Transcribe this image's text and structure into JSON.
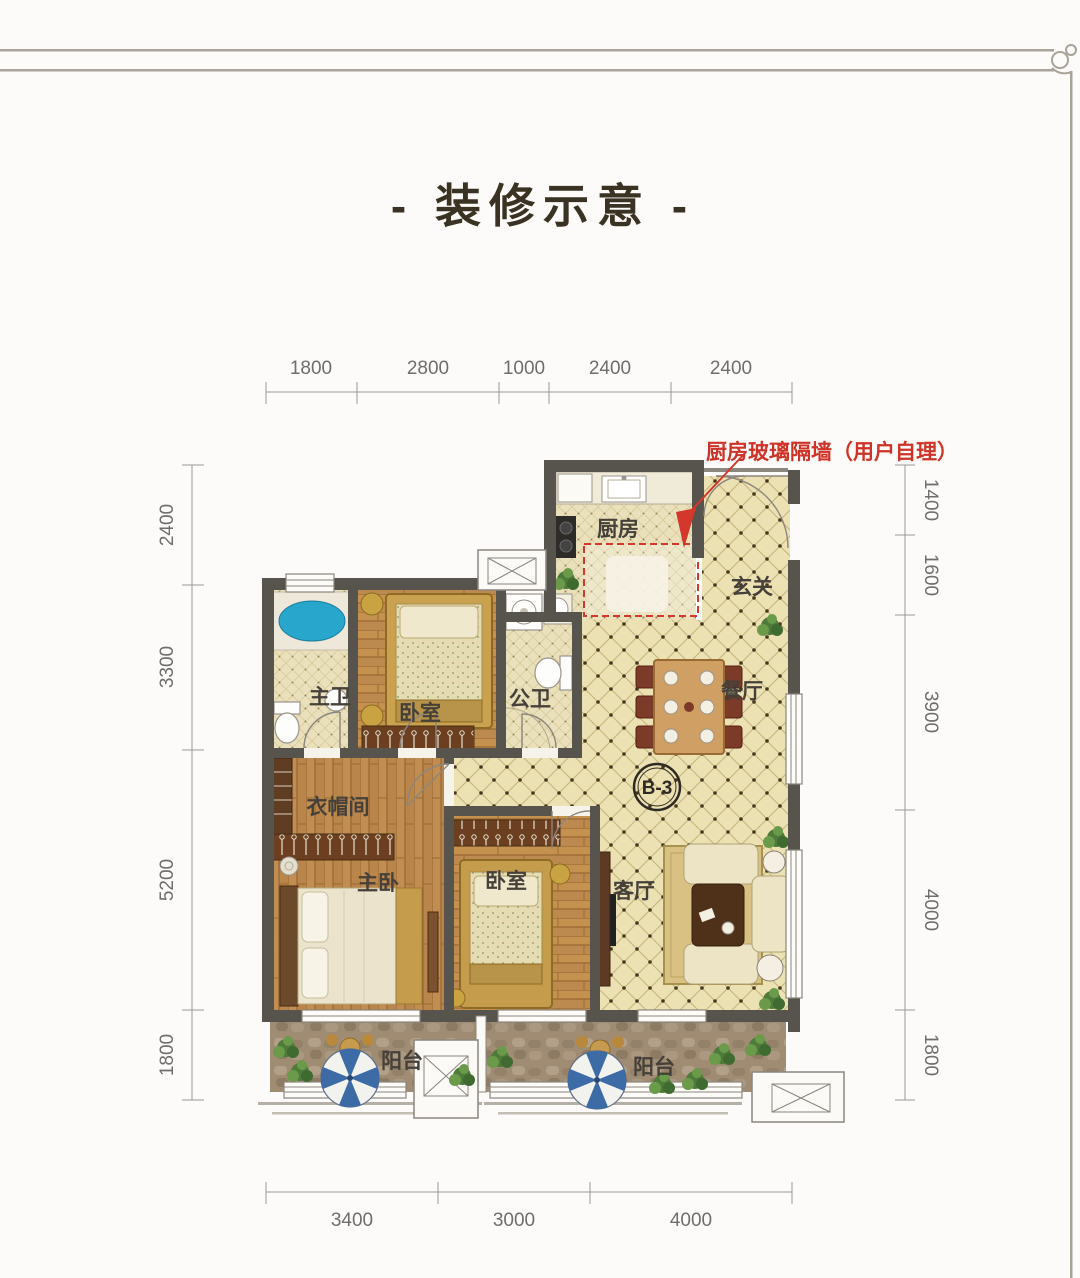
{
  "title": "- 装修示意 -",
  "annotation": {
    "text": "厨房玻璃隔墙（用户自理）",
    "color": "#cf3227"
  },
  "unit_label": "B-3",
  "dimensions": {
    "top": [
      "1800",
      "2800",
      "1000",
      "2400",
      "2400"
    ],
    "bottom": [
      "3400",
      "3000",
      "4000"
    ],
    "left": [
      "2400",
      "3300",
      "5200",
      "1800"
    ],
    "right": [
      "1400",
      "1600",
      "3900",
      "4000",
      "1800"
    ]
  },
  "rooms": {
    "kitchen": "厨房",
    "entry": "玄关",
    "dining": "餐厅",
    "living": "客厅",
    "master_bath": "主卫",
    "public_bath": "公卫",
    "bedroom_top": "卧室",
    "bedroom_mid": "卧室",
    "master_bedroom": "主卧",
    "cloakroom": "衣帽间",
    "balcony_left": "阳台",
    "balcony_right": "阳台"
  },
  "colors": {
    "title_text": "#3a3222",
    "annotation_red": "#cf3227",
    "wall": "#57534d",
    "tile_floor": "#ece1b2",
    "wood_floor": "#b9854a",
    "balcony_stone": "#a08c72",
    "tub_blue": "#29a6cb",
    "umbrella_blue": "#3c6ba5",
    "dimension_text": "#6e6e6e"
  }
}
